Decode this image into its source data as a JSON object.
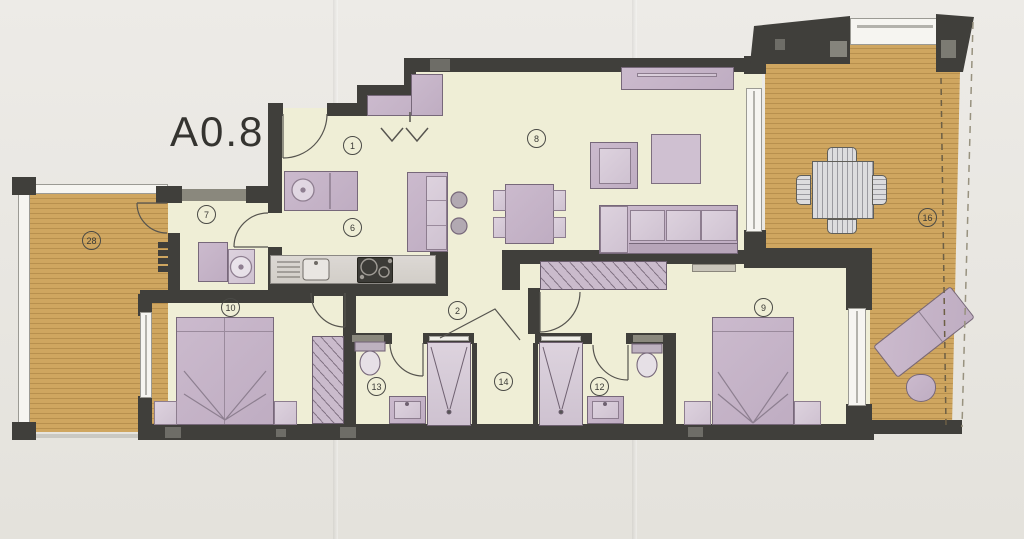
{
  "document": {
    "unit_label": "A0.8"
  },
  "plan": {
    "room_markers": [
      {
        "label": "1",
        "name": "entry-hall"
      },
      {
        "label": "2",
        "name": "hallway"
      },
      {
        "label": "6",
        "name": "kitchen"
      },
      {
        "label": "7",
        "name": "utility-room"
      },
      {
        "label": "8",
        "name": "living-room"
      },
      {
        "label": "9",
        "name": "bedroom-right"
      },
      {
        "label": "10",
        "name": "bedroom-left"
      },
      {
        "label": "12",
        "name": "bathroom-right"
      },
      {
        "label": "13",
        "name": "bathroom-left"
      },
      {
        "label": "14",
        "name": "inner-hall"
      },
      {
        "label": "16",
        "name": "terrace-right"
      },
      {
        "label": "28",
        "name": "terrace-left"
      }
    ],
    "colors": {
      "paper": "#e9e7e2",
      "floor": "#efeed6",
      "wall": "#403f3b",
      "deck_wood": "#cfa660",
      "furniture": "#c5b3c7",
      "window": "#f6f5f1"
    }
  }
}
